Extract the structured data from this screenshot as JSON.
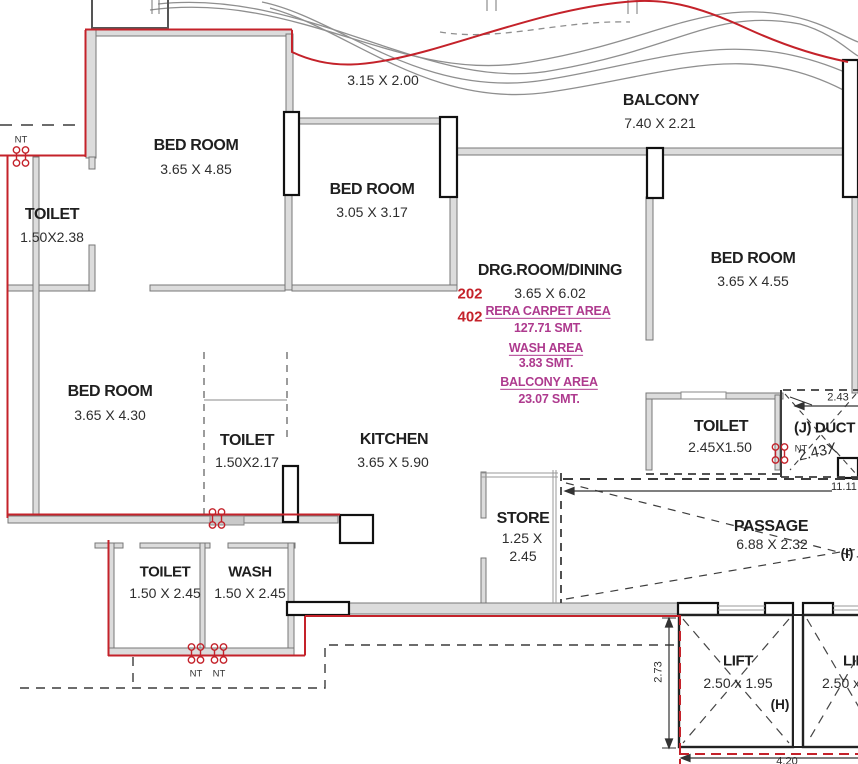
{
  "colors": {
    "boundary_red": "#C4222A",
    "area_magenta": "#AE3A8E",
    "wall_fill": "#dcdcdc",
    "wall_dark": "#111111",
    "text_dark": "#1f1f1f"
  },
  "rooms": {
    "bedroom1": {
      "name": "BED ROOM",
      "dim": "3.65 X 4.85"
    },
    "bedroom2": {
      "name": "BED ROOM",
      "dim": "3.05 X 3.17"
    },
    "bedroom3": {
      "name": "BED ROOM",
      "dim": "3.65 X 4.30"
    },
    "bedroom4": {
      "name": "BED ROOM",
      "dim": "3.65 X 4.55"
    },
    "toilet1": {
      "name": "TOILET",
      "dim": "1.50X2.38"
    },
    "toilet2": {
      "name": "TOILET",
      "dim": "1.50X2.17"
    },
    "toilet3": {
      "name": "TOILET",
      "dim": "2.45X1.50"
    },
    "toilet4": {
      "name": "TOILET",
      "dim": "1.50 X 2.45"
    },
    "wash": {
      "name": "WASH",
      "dim": "1.50 X 2.45"
    },
    "balcony": {
      "name": "BALCONY",
      "dim": "7.40 X 2.21"
    },
    "drg": {
      "name": "DRG.ROOM/DINING",
      "dim": "3.65 X 6.02"
    },
    "kitchen": {
      "name": "KITCHEN",
      "dim": "3.65 X 5.90"
    },
    "store": {
      "name": "STORE",
      "dim_l1": "1.25 X",
      "dim_l2": "2.45"
    },
    "passage": {
      "name": "PASSAGE",
      "dim": "6.88 X 2.32",
      "tag": "(I)"
    },
    "duct": {
      "name": "(J) DUCT",
      "dim_slant": "2.43X",
      "tag": "(J)"
    },
    "lift1": {
      "name": "LIFT",
      "dim": "2.50 x 1.95",
      "tag": "(H)"
    },
    "lift2": {
      "name": "LIFT",
      "dim": "2.50 x 1.95"
    }
  },
  "units": {
    "first": "202",
    "second": "402"
  },
  "areas": {
    "carpet_label": "RERA CARPET AREA",
    "carpet_value": "127.71 SMT.",
    "wash_label": "WASH AREA",
    "wash_value": "3.83 SMT.",
    "balcony_label": "BALCONY AREA",
    "balcony_value": "23.07 SMT."
  },
  "dims": {
    "balcony_small": "3.15 X 2.00",
    "duct_top": "2.43",
    "passage_total": "11.11",
    "lift_side": "2.73",
    "lift_bottom": "4.20"
  },
  "markers": {
    "nt": "NT"
  }
}
